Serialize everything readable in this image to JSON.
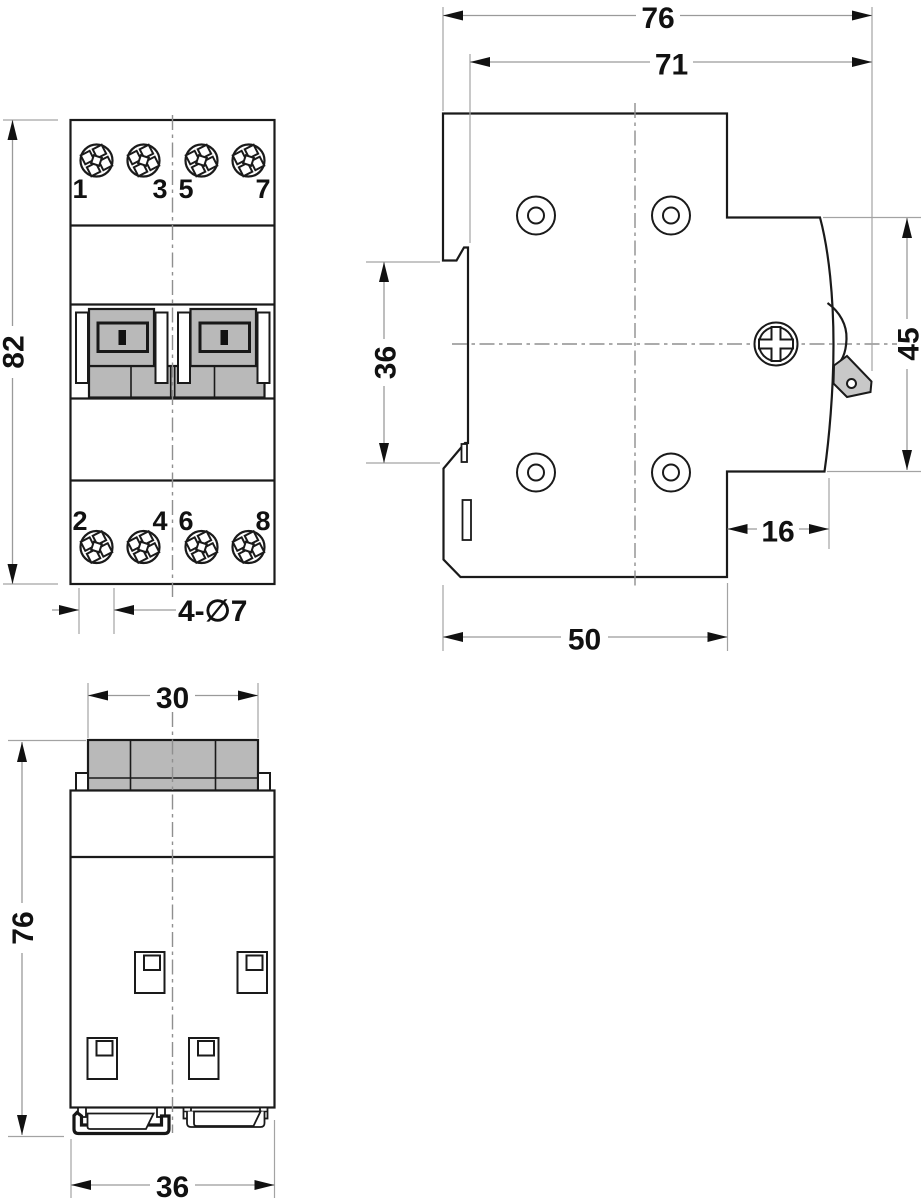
{
  "drawing": {
    "type": "technical-dimension-drawing",
    "colors": {
      "outline": "#1a1a1a",
      "dimension_lines": "#9a9a9a",
      "component_gray": "#b9b9b9",
      "lever_gray": "#c8c8c8",
      "slot_black": "#111111",
      "background": "#ffffff"
    },
    "front_view": {
      "terminals_top": [
        "1",
        "3",
        "5",
        "7"
      ],
      "terminals_bottom": [
        "2",
        "4",
        "6",
        "8"
      ],
      "dim_height": "82",
      "dim_holes": "4-∅7"
    },
    "side_view": {
      "dim_total_depth": "76",
      "dim_depth": "71",
      "dim_rail_opening": "36",
      "dim_front_height": "45",
      "dim_step": "16",
      "dim_base_depth": "50"
    },
    "bottom_view": {
      "dim_handle_width": "30",
      "dim_depth": "76",
      "dim_width": "36"
    }
  }
}
